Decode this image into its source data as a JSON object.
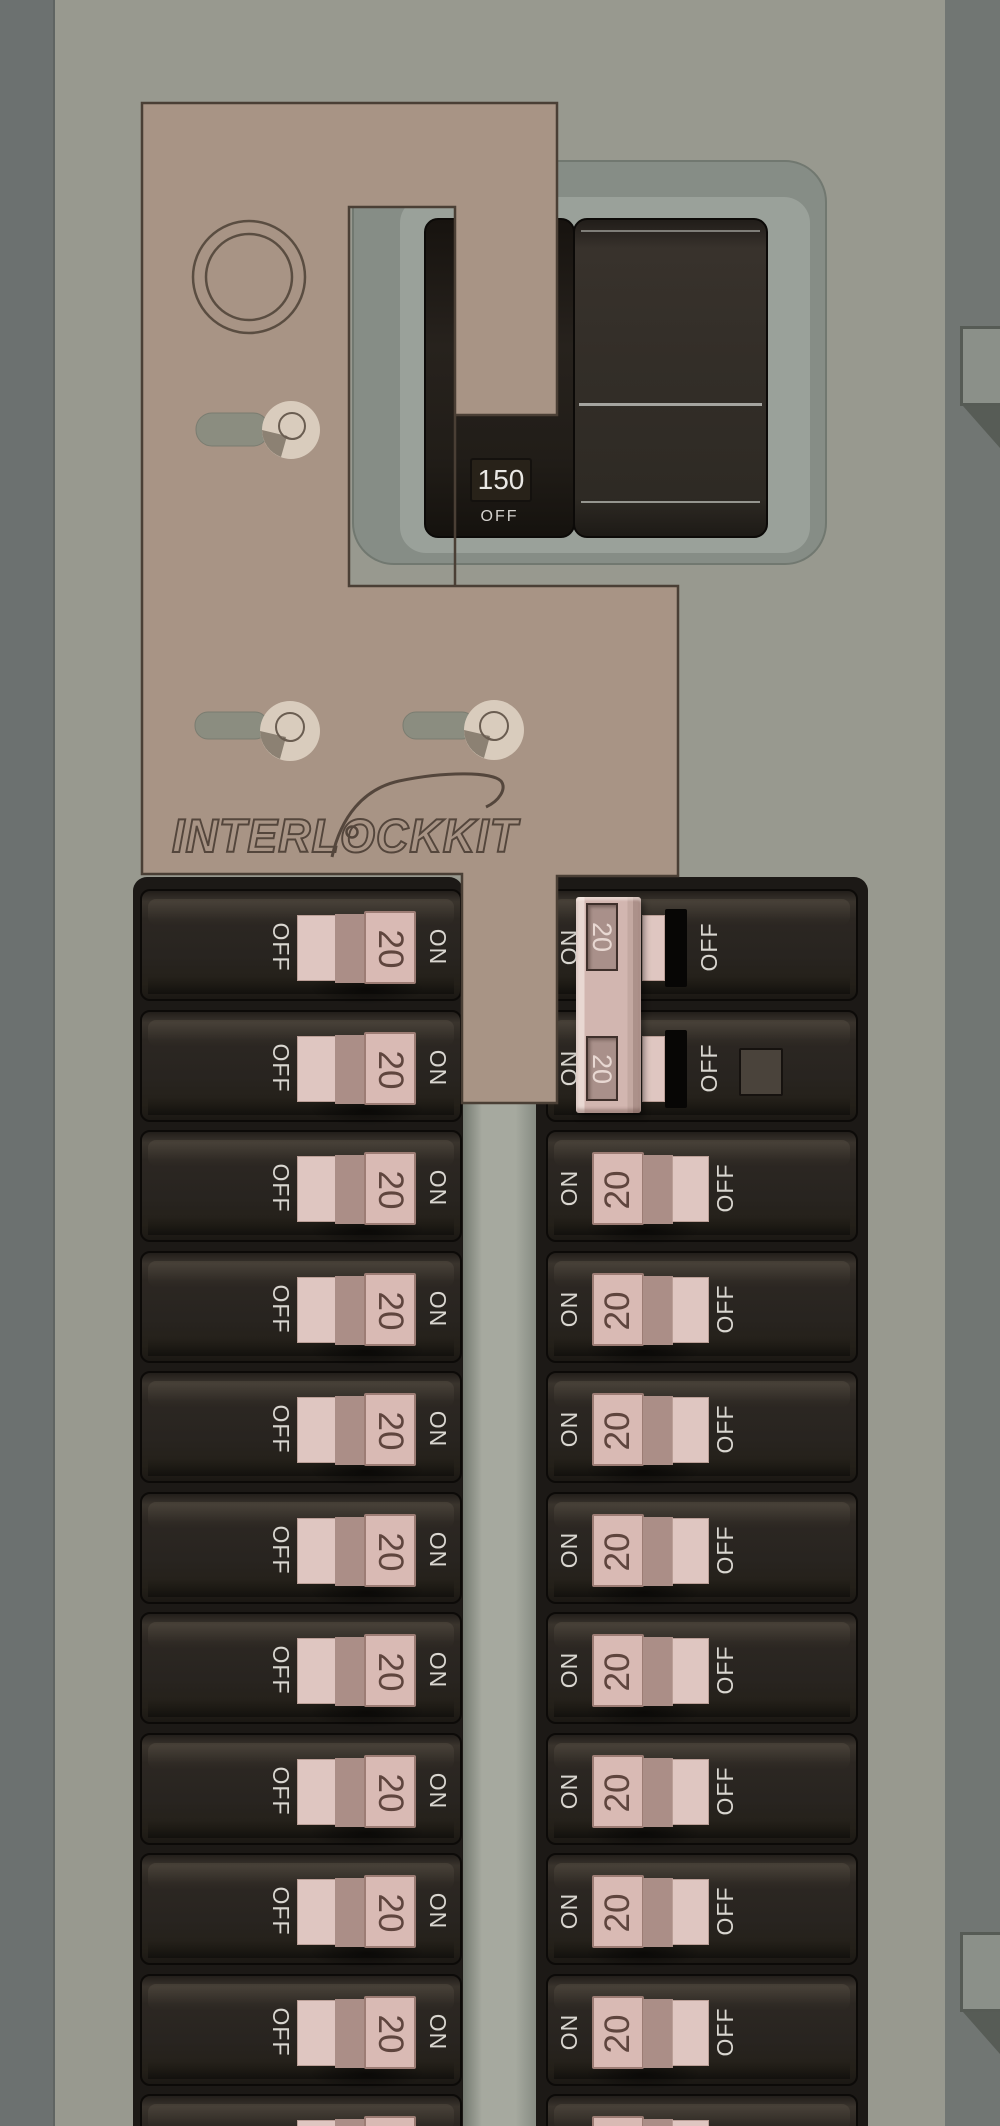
{
  "colors": {
    "panel_background": "#98998f",
    "plate_tan": "#a89485",
    "breaker_body": "#282420",
    "handle_pink": "#d9bab4",
    "label_text": "#d9d6d0",
    "amp_text": "#5f453e",
    "bezel_gray": "#868d86",
    "backdrop_black": "#1c1916",
    "tie_bar_pink": "#d2b6b0"
  },
  "interlock_plate": {
    "brand": "INTERLOCKKIT"
  },
  "main_breaker": {
    "rating": "150",
    "state_label": "OFF"
  },
  "generator_tie_bar": {
    "amps": [
      "20",
      "20"
    ]
  },
  "left_column": {
    "breakers": [
      {
        "off_label": "OFF",
        "amp": "20",
        "on_label": "ON"
      },
      {
        "off_label": "OFF",
        "amp": "20",
        "on_label": "ON"
      },
      {
        "off_label": "OFF",
        "amp": "20",
        "on_label": "ON"
      },
      {
        "off_label": "OFF",
        "amp": "20",
        "on_label": "ON"
      },
      {
        "off_label": "OFF",
        "amp": "20",
        "on_label": "ON"
      },
      {
        "off_label": "OFF",
        "amp": "20",
        "on_label": "ON"
      },
      {
        "off_label": "OFF",
        "amp": "20",
        "on_label": "ON"
      },
      {
        "off_label": "OFF",
        "amp": "20",
        "on_label": "ON"
      },
      {
        "off_label": "OFF",
        "amp": "20",
        "on_label": "ON"
      },
      {
        "off_label": "OFF",
        "amp": "20",
        "on_label": "ON"
      },
      {
        "off_label": "OFF",
        "amp": "20",
        "on_label": "ON"
      }
    ]
  },
  "right_column": {
    "breakers": [
      {
        "on_label": "ON",
        "off_label": "OFF",
        "tied": true
      },
      {
        "on_label": "ON",
        "off_label": "OFF",
        "tied": true,
        "has_retainer": true
      },
      {
        "on_label": "ON",
        "amp": "20",
        "off_label": "OFF"
      },
      {
        "on_label": "ON",
        "amp": "20",
        "off_label": "OFF"
      },
      {
        "on_label": "ON",
        "amp": "20",
        "off_label": "OFF"
      },
      {
        "on_label": "ON",
        "amp": "20",
        "off_label": "OFF"
      },
      {
        "on_label": "ON",
        "amp": "20",
        "off_label": "OFF"
      },
      {
        "on_label": "ON",
        "amp": "20",
        "off_label": "OFF"
      },
      {
        "on_label": "ON",
        "amp": "20",
        "off_label": "OFF"
      },
      {
        "on_label": "ON",
        "amp": "20",
        "off_label": "OFF"
      },
      {
        "on_label": "ON",
        "amp": "20",
        "off_label": "OFF"
      }
    ]
  }
}
